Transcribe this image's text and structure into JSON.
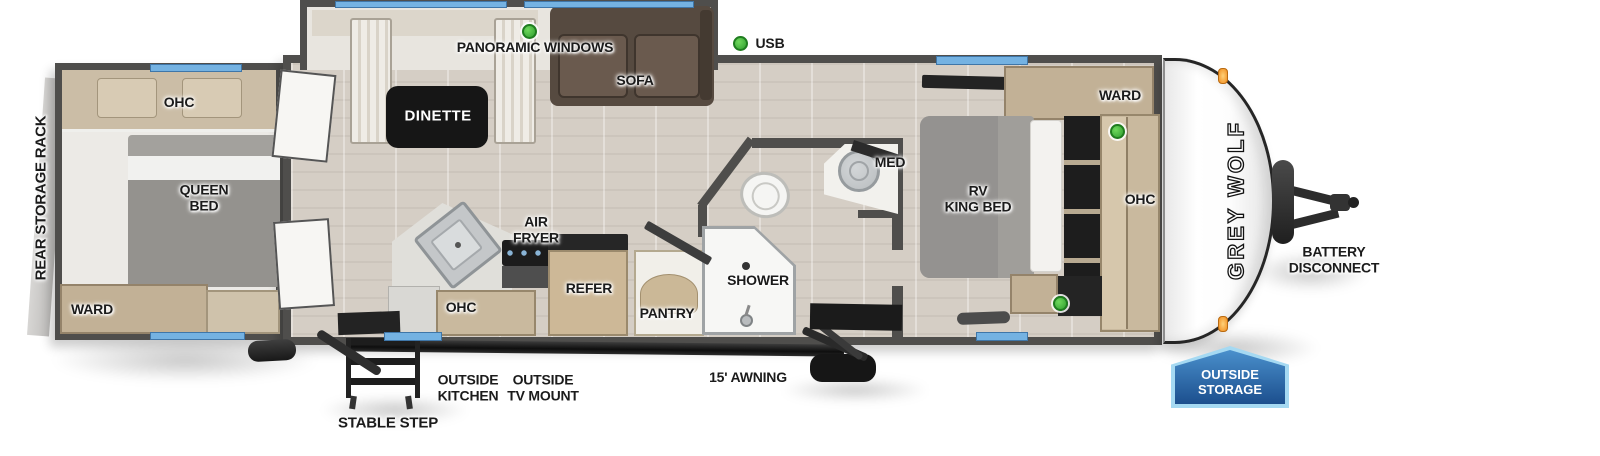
{
  "title": "Grey Wolf travel trailer floorplan",
  "colors": {
    "wall_gray": "#4f4e4c",
    "window_blue": "#74b2e2",
    "usb_green": "#3fae3a",
    "badge_blue_dark": "#1c4f8e",
    "badge_blue_light": "#4a90cc",
    "floor_wood": "#d5cec5",
    "sofa_brown": "#564a40"
  },
  "labels": {
    "rear_storage_rack": "REAR STORAGE RACK",
    "rear_ohc": "OHC",
    "queen_bed_1": "QUEEN",
    "queen_bed_2": "BED",
    "rear_ward": "WARD",
    "panoramic_windows": "PANORAMIC WINDOWS",
    "dinette": "DINETTE",
    "sofa": "SOFA",
    "usb": "USB",
    "air_fryer_1": "AIR",
    "air_fryer_2": "FRYER",
    "kitchen_ohc": "OHC",
    "refer": "REFER",
    "pantry": "PANTRY",
    "shower": "SHOWER",
    "med": "MED",
    "rv_king_bed_1": "RV",
    "rv_king_bed_2": "KING BED",
    "front_ward": "WARD",
    "front_ohc": "OHC",
    "brand": "GREY WOLF",
    "battery_disconnect_1": "BATTERY",
    "battery_disconnect_2": "DISCONNECT",
    "outside_storage_1": "OUTSIDE",
    "outside_storage_2": "STORAGE",
    "outside_kitchen_1": "OUTSIDE",
    "outside_kitchen_2": "KITCHEN",
    "outside_tv_1": "OUTSIDE",
    "outside_tv_2": "TV MOUNT",
    "awning": "15' AWNING",
    "stable_step": "STABLE STEP"
  }
}
